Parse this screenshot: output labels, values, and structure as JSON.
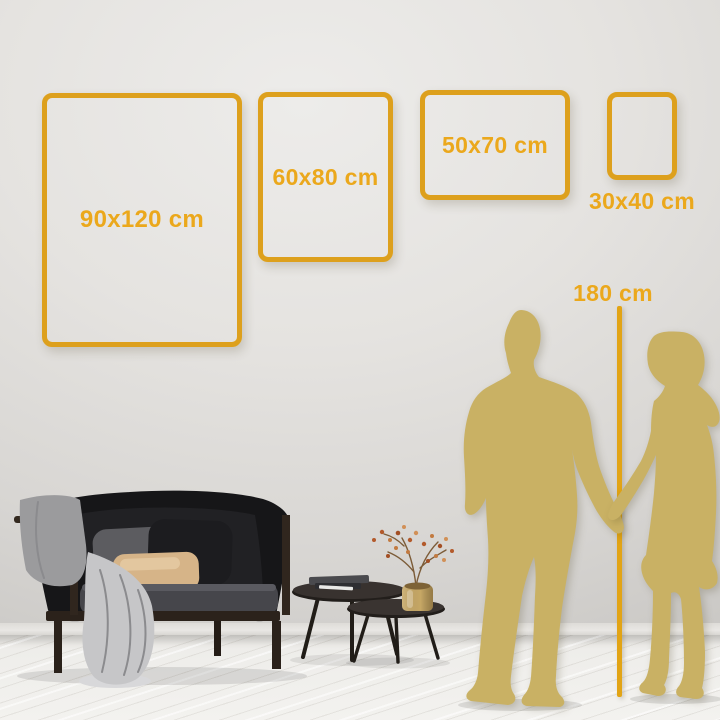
{
  "frames": [
    {
      "label": "90x120 cm"
    },
    {
      "label": "60x80 cm"
    },
    {
      "label": "50x70 cm"
    },
    {
      "label": "30x40 cm"
    }
  ],
  "height_reference": {
    "label": "180 cm"
  },
  "colors": {
    "frame_gold": "#DDA01D",
    "label_gold": "#EBA81C",
    "line_gold": "#E2A415",
    "silhouette_gold": "#C9B164",
    "wall_light": "#EDECEA",
    "wall_dark": "#C6C4C1",
    "floor_light": "#F3F2EF",
    "sofa_black": "#161618",
    "pillow_tan": "#D6B488",
    "blanket_grey": "#C6C6C8",
    "vase_brass": "#C6A765"
  }
}
